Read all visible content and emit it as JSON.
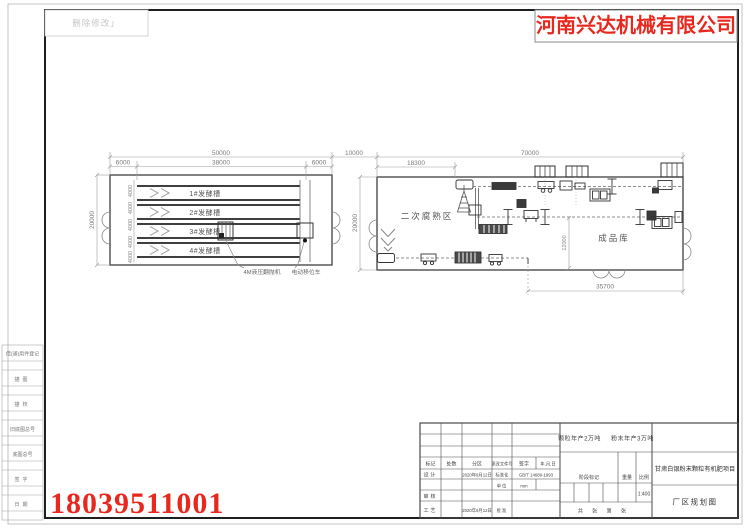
{
  "company_name": "河南兴达机械有限公司",
  "stamp_note": "删除修改」",
  "phone_number": "18039511001",
  "drawing": {
    "fermentation_building": {
      "dim_total_width": "50000",
      "dim_left_bay": "6000",
      "dim_main_bay": "38000",
      "dim_right_bay": "6000",
      "dim_height": "20000",
      "dim_trough_pitch": "4000",
      "troughs": [
        "1#发酵槽",
        "2#发酵槽",
        "3#发酵槽",
        "4#发酵槽"
      ],
      "label_turner": "4M液压翻抛机",
      "label_shifter": "电动移位车"
    },
    "dim_gap": "10000",
    "production_building": {
      "dim_total_width": "70000",
      "dim_left_section": "18300",
      "dim_height": "20000",
      "dim_warehouse_depth": "12000",
      "dim_warehouse_width": "35700",
      "label_curing_area": "二次腐熟区",
      "label_warehouse": "成品库"
    }
  },
  "left_strip": {
    "rows": [
      "借(通)用件登记",
      "描图",
      "描校",
      "旧底图总号",
      "底图总号",
      "签字",
      "日期"
    ]
  },
  "title_block": {
    "production_note": "颗粒年产2万吨 粉末年产3万吨",
    "project_name": "甘肃白银粉末颗粒有机肥项目",
    "drawing_title": "厂区规划图",
    "col_mark": "标记",
    "col_count": "处数",
    "col_zone": "分区",
    "col_change_no": "更改文件号",
    "col_sign": "签字",
    "col_date": "年,月,日",
    "design_label": "设计",
    "design_date": "2020年9月12日",
    "standard_label": "标准化",
    "standard_value": "GB/T 14689-1993",
    "unit_label": "单位",
    "unit_value": "mm",
    "review_label": "审核",
    "process_label": "工艺",
    "process_date": "2020年9月12日",
    "approve_label": "批准",
    "stage_label": "阶段标记",
    "weight_label": "重量",
    "scale_label": "比例",
    "scale_value": "1:400",
    "sheet_note": "共 张 第 张"
  }
}
